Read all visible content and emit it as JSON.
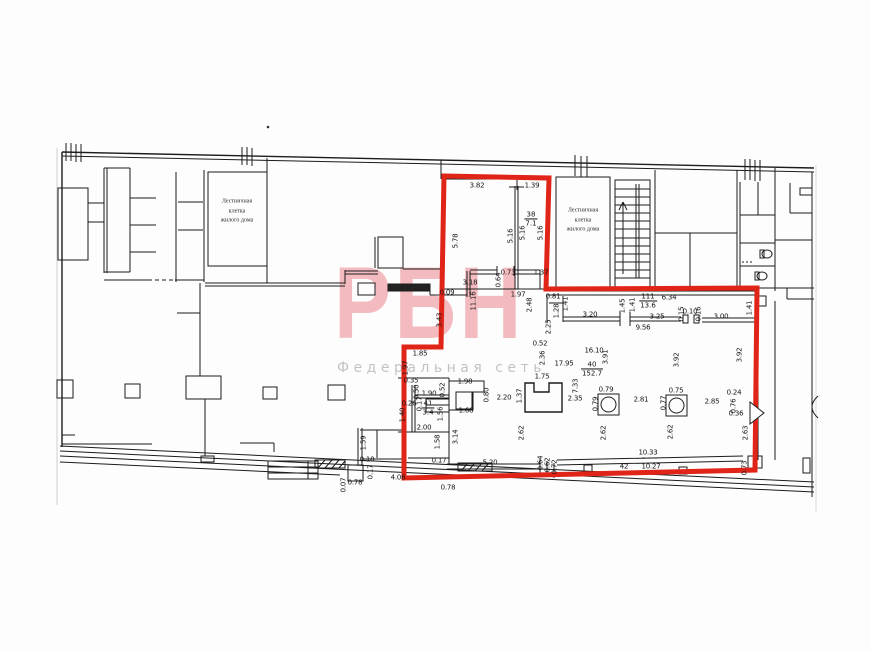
{
  "watermark": {
    "logo": "РБН",
    "subtitle": "Федеральная сеть",
    "logo_color": "#f2b4b9",
    "subtitle_color": "#c3c3c3"
  },
  "plan": {
    "red_outline_color": "#e02418",
    "line_color": "#1c1c1c",
    "stair_rooms": [
      {
        "lines": [
          "Лестничная",
          "клетка",
          "жилого дома"
        ],
        "x": 237,
        "y": 212
      },
      {
        "lines": [
          "Лестничная",
          "клетка",
          "жилого дома"
        ],
        "x": 583,
        "y": 221
      }
    ],
    "room_tags": [
      {
        "num": "38",
        "area": "7.1",
        "x": 531,
        "y": 219
      },
      {
        "num": "111",
        "area": "13.6",
        "x": 648,
        "y": 301
      },
      {
        "num": "40",
        "area": "152.7",
        "x": 592,
        "y": 369
      },
      {
        "num": "41",
        "area": "3.4",
        "x": 428,
        "y": 408
      }
    ],
    "dims": [
      {
        "t": "3.82",
        "x": 477,
        "y": 186
      },
      {
        "t": "1.39",
        "x": 532,
        "y": 186
      },
      {
        "t": "5.78",
        "x": 456,
        "y": 241,
        "r": -90
      },
      {
        "t": "5.16",
        "x": 511,
        "y": 236,
        "r": -90
      },
      {
        "t": "5.16",
        "x": 523,
        "y": 233,
        "r": -90
      },
      {
        "t": "5.16",
        "x": 541,
        "y": 233,
        "r": -90
      },
      {
        "t": "3.18",
        "x": 470,
        "y": 283
      },
      {
        "t": "0.09",
        "x": 447,
        "y": 293
      },
      {
        "t": "11.16",
        "x": 474,
        "y": 301,
        "r": -90
      },
      {
        "t": "0.64",
        "x": 499,
        "y": 280,
        "r": -90
      },
      {
        "t": "0.73",
        "x": 508,
        "y": 273
      },
      {
        "t": "1.37",
        "x": 541,
        "y": 273
      },
      {
        "t": "1.97",
        "x": 518,
        "y": 295
      },
      {
        "t": "2.48",
        "x": 530,
        "y": 305,
        "r": -90
      },
      {
        "t": "2.25",
        "x": 549,
        "y": 327,
        "r": -90
      },
      {
        "t": "0.52",
        "x": 540,
        "y": 344
      },
      {
        "t": "2.36",
        "x": 543,
        "y": 358,
        "r": -90
      },
      {
        "t": "3.43",
        "x": 440,
        "y": 320,
        "r": -90
      },
      {
        "t": "1.85",
        "x": 420,
        "y": 354
      },
      {
        "t": "1.97",
        "x": 406,
        "y": 368,
        "r": -90
      },
      {
        "t": "0.35",
        "x": 411,
        "y": 381
      },
      {
        "t": "0.50",
        "x": 417,
        "y": 392,
        "r": -90
      },
      {
        "t": "1.90",
        "x": 429,
        "y": 394
      },
      {
        "t": "0.52",
        "x": 443,
        "y": 390,
        "r": -90
      },
      {
        "t": "1.98",
        "x": 465,
        "y": 382
      },
      {
        "t": "0.26",
        "x": 409,
        "y": 404
      },
      {
        "t": "0.17",
        "x": 420,
        "y": 404,
        "r": -90
      },
      {
        "t": "1.40",
        "x": 403,
        "y": 415,
        "r": -90
      },
      {
        "t": "1.56",
        "x": 441,
        "y": 414,
        "r": -90
      },
      {
        "t": "2.00",
        "x": 424,
        "y": 428
      },
      {
        "t": "1.58",
        "x": 438,
        "y": 442,
        "r": -90
      },
      {
        "t": "3.14",
        "x": 456,
        "y": 437,
        "r": -90
      },
      {
        "t": "1.68",
        "x": 466,
        "y": 411
      },
      {
        "t": "0.80",
        "x": 487,
        "y": 395,
        "r": -90
      },
      {
        "t": "2.20",
        "x": 504,
        "y": 398
      },
      {
        "t": "1.37",
        "x": 520,
        "y": 396,
        "r": -90
      },
      {
        "t": "1.75",
        "x": 542,
        "y": 377
      },
      {
        "t": "0.17",
        "x": 439,
        "y": 461
      },
      {
        "t": "5.20",
        "x": 490,
        "y": 463
      },
      {
        "t": "0.64",
        "x": 541,
        "y": 463,
        "r": -90
      },
      {
        "t": "0.62",
        "x": 548,
        "y": 465,
        "r": -90
      },
      {
        "t": "0.72",
        "x": 555,
        "y": 467,
        "r": -90
      },
      {
        "t": "4.06",
        "x": 398,
        "y": 478
      },
      {
        "t": "0.78",
        "x": 448,
        "y": 488
      },
      {
        "t": "0.07",
        "x": 344,
        "y": 485,
        "r": -90
      },
      {
        "t": "0.78",
        "x": 355,
        "y": 483
      },
      {
        "t": "1.59",
        "x": 364,
        "y": 443,
        "r": -90
      },
      {
        "t": "0.18",
        "x": 367,
        "y": 460
      },
      {
        "t": "0.17",
        "x": 371,
        "y": 472,
        "r": -90
      },
      {
        "t": "0.81",
        "x": 553,
        "y": 297
      },
      {
        "t": "1.28",
        "x": 557,
        "y": 311,
        "r": -90
      },
      {
        "t": "1.41",
        "x": 566,
        "y": 304,
        "r": -90
      },
      {
        "t": "3.20",
        "x": 590,
        "y": 315
      },
      {
        "t": "1.45",
        "x": 623,
        "y": 306,
        "r": -90
      },
      {
        "t": "1.41",
        "x": 633,
        "y": 305,
        "r": -90
      },
      {
        "t": "6.34",
        "x": 669,
        "y": 298
      },
      {
        "t": "3.25",
        "x": 657,
        "y": 317
      },
      {
        "t": "0.15",
        "x": 682,
        "y": 314,
        "r": -90
      },
      {
        "t": "0.10",
        "x": 690,
        "y": 312
      },
      {
        "t": "0.16",
        "x": 699,
        "y": 314,
        "r": -90
      },
      {
        "t": "3.00",
        "x": 721,
        "y": 317
      },
      {
        "t": "1.41",
        "x": 750,
        "y": 308,
        "r": -90
      },
      {
        "t": "9.56",
        "x": 643,
        "y": 328
      },
      {
        "t": "16.10",
        "x": 594,
        "y": 351
      },
      {
        "t": "3.91",
        "x": 606,
        "y": 357,
        "r": -90
      },
      {
        "t": "17.95",
        "x": 564,
        "y": 364
      },
      {
        "t": "7.33",
        "x": 576,
        "y": 386,
        "r": -90
      },
      {
        "t": "2.35",
        "x": 575,
        "y": 399
      },
      {
        "t": "0.79",
        "x": 606,
        "y": 390
      },
      {
        "t": "0.79",
        "x": 596,
        "y": 404,
        "r": -90
      },
      {
        "t": "2.81",
        "x": 641,
        "y": 400
      },
      {
        "t": "0.77",
        "x": 664,
        "y": 403,
        "r": -90
      },
      {
        "t": "0.75",
        "x": 676,
        "y": 391
      },
      {
        "t": "2.85",
        "x": 712,
        "y": 402
      },
      {
        "t": "0.24",
        "x": 734,
        "y": 393
      },
      {
        "t": "0.76",
        "x": 734,
        "y": 406,
        "r": -90
      },
      {
        "t": "0.36",
        "x": 736,
        "y": 414
      },
      {
        "t": "3.92",
        "x": 677,
        "y": 360,
        "r": -90
      },
      {
        "t": "3.92",
        "x": 740,
        "y": 355,
        "r": -90
      },
      {
        "t": "2.62",
        "x": 522,
        "y": 433,
        "r": -90
      },
      {
        "t": "2.62",
        "x": 604,
        "y": 433,
        "r": -90
      },
      {
        "t": "2.62",
        "x": 671,
        "y": 432,
        "r": -90
      },
      {
        "t": "2.63",
        "x": 746,
        "y": 433,
        "r": -90
      },
      {
        "t": "10.33",
        "x": 648,
        "y": 453
      },
      {
        "t": "10.27",
        "x": 651,
        "y": 467
      },
      {
        "t": "42",
        "x": 624,
        "y": 467
      },
      {
        "t": "0.73",
        "x": 745,
        "y": 468,
        "r": -90
      }
    ]
  }
}
